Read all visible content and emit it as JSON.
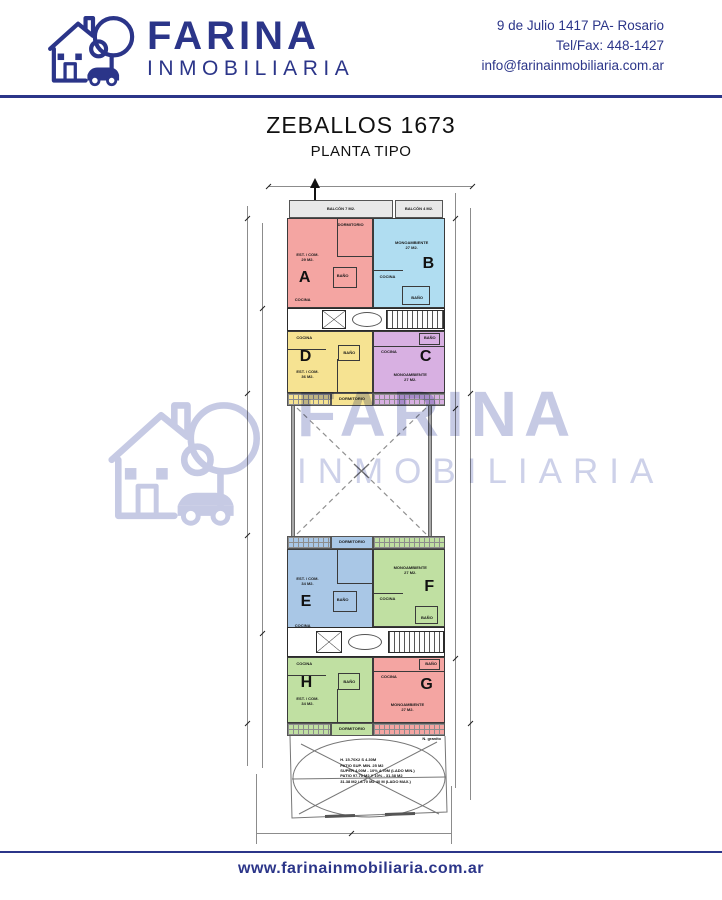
{
  "brand": {
    "name": "FARINA",
    "tagline": "INMOBILIARIA",
    "address": "9 de Julio 1417 PA- Rosario",
    "phone": "Tel/Fax: 448-1427",
    "email": "info@farinainmobiliaria.com.ar",
    "website": "www.farinainmobiliaria.com.ar"
  },
  "colors": {
    "navy": "#2b3589",
    "watermark": "#c6cae4",
    "hatch_gray": "#e8e8e8"
  },
  "title": {
    "main": "ZEBALLOS 1673",
    "sub": "PLANTA TIPO"
  },
  "watermark": {
    "line1": "FARINA",
    "line2": "INMOBILIARIA"
  },
  "plan": {
    "balcony_left": "BALCÓN 7 M2.",
    "balcony_right": "BALCÓN 4 M2.",
    "room_labels": {
      "dorm": "DORMITORIO",
      "kitchen": "COCINA",
      "bath": "BAÑO"
    },
    "units": [
      {
        "letter": "A",
        "use": "EST. / COM.",
        "area": "29 M2.",
        "color": "#f4a5a2"
      },
      {
        "letter": "B",
        "use": "MONOAMBIENTE",
        "area": "27 M2.",
        "color": "#b0ddf1"
      },
      {
        "letter": "C",
        "use": "MONOAMBIENTE",
        "area": "27 M2.",
        "color": "#d8b0e2"
      },
      {
        "letter": "D",
        "use": "EST. / COM.",
        "area": "36 M2.",
        "color": "#f6e392"
      },
      {
        "letter": "E",
        "use": "EST. / COM.",
        "area": "34 M2.",
        "color": "#a9c7e6"
      },
      {
        "letter": "F",
        "use": "MONOAMBIENTE",
        "area": "27 M2.",
        "color": "#c0e0a2"
      },
      {
        "letter": "G",
        "use": "MONOAMBIENTE",
        "area": "27 M2.",
        "color": "#f4a5a2"
      },
      {
        "letter": "H",
        "use": "EST. / COM.",
        "area": "34 M2.",
        "color": "#c0e0a2"
      }
    ],
    "patio_notes": [
      "H. 15.70X2 S 4.30M",
      "PATIO SUP. MIN. 25 M2",
      "SUPER 4.00M - 10% 4.70M (LADO MIN.)",
      "PATIO 97.70 M2 Y 10% - 31.38 M2",
      "31.38 M2 / 6.70 M2 40 M (LADO MAX.)"
    ],
    "patio_side_note": "N. granito"
  }
}
